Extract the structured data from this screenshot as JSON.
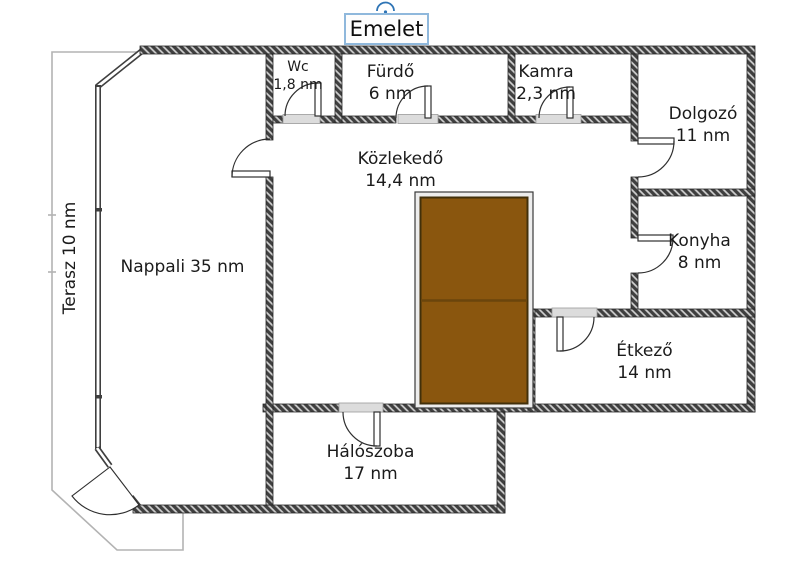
{
  "title": "Emelet",
  "rooms": {
    "wc": {
      "label": "Wc",
      "area": "1,8 nm"
    },
    "furdo": {
      "label": "Fürdő",
      "area": "6 nm"
    },
    "kamra": {
      "label": "Kamra",
      "area": "2,3 nm"
    },
    "dolgozo": {
      "label": "Dolgozó",
      "area": "11 nm"
    },
    "kozlekedo": {
      "label": "Közlekedő",
      "area": "14,4 nm"
    },
    "konyha": {
      "label": "Konyha",
      "area": "8 nm"
    },
    "etkezo": {
      "label": "Étkező",
      "area": "14 nm"
    },
    "haloszoba": {
      "label": "Hálószoba",
      "area": "17 nm"
    },
    "nappali": {
      "label": "Nappali",
      "area": "35 nm"
    },
    "terasz": {
      "label": "Terasz",
      "area": "10 nm"
    }
  },
  "colors": {
    "wall_dark": "#3f3f3f",
    "wall_hatch_light": "#d2d2d2",
    "stair_fill": "#8a560e",
    "stair_divider": "#6b450c",
    "terrace_line": "#b3b3b3",
    "selection_border": "#8fb8dc",
    "rotate_handle": "#2e74b5",
    "door_sill": "#dcdcdc"
  }
}
